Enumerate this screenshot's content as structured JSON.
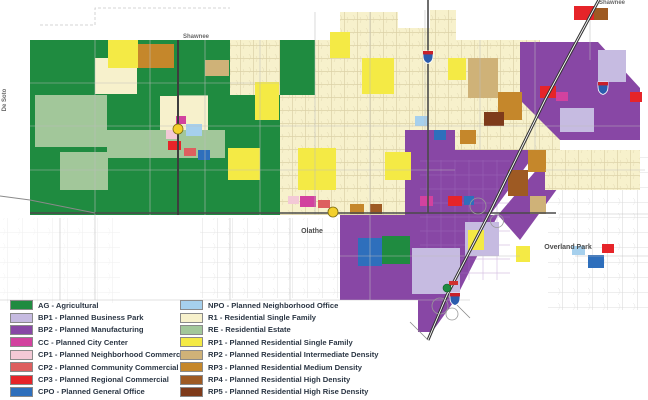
{
  "title": "Future land use zoning map",
  "zone_colors": {
    "AG": "#1f8b40",
    "BP1": "#c6bbe1",
    "BP2": "#8847a5",
    "CC": "#d2429f",
    "CP1": "#f3c9d6",
    "CP2": "#dd5f5f",
    "CP3": "#e62429",
    "CPO": "#2e6fbc",
    "NPO": "#a6d0ed",
    "R1": "#f7f1cc",
    "RE": "#a2c79a",
    "RP1": "#f4ea45",
    "RP2": "#cfb278",
    "RP3": "#c5872b",
    "RP4": "#9e5a23",
    "RP5": "#7e3a1a"
  },
  "map": {
    "labels": {
      "shawnee_inner": "Shawnee",
      "shawnee_corner": "Shawnee",
      "desoto": "De Soto",
      "olathe": "Olathe",
      "overland_park": "Overland Park"
    },
    "markers": {
      "state_route_color": "#f3d02c",
      "interstate_blue": "#2b5cad",
      "interstate_red": "#c8202a"
    }
  },
  "legend": {
    "left": [
      {
        "code": "AG",
        "label": "AG - Agricultural"
      },
      {
        "code": "BP1",
        "label": "BP1 - Planned Business Park"
      },
      {
        "code": "BP2",
        "label": "BP2 - Planned Manufacturing"
      },
      {
        "code": "CC",
        "label": "CC - Planned City Center"
      },
      {
        "code": "CP1",
        "label": "CP1 - Planned Neighborhood Commercial"
      },
      {
        "code": "CP2",
        "label": "CP2 - Planned Community Commercial"
      },
      {
        "code": "CP3",
        "label": "CP3 - Planned Regional Commercial"
      },
      {
        "code": "CPO",
        "label": "CPO - Planned General Office"
      }
    ],
    "right": [
      {
        "code": "NPO",
        "label": "NPO - Planned Neighborhood Office"
      },
      {
        "code": "R1",
        "label": "R1 - Residential Single Family"
      },
      {
        "code": "RE",
        "label": "RE - Residential Estate"
      },
      {
        "code": "RP1",
        "label": "RP1 - Planned Residential Single Family"
      },
      {
        "code": "RP2",
        "label": "RP2 - Planned Residential Intermediate Density"
      },
      {
        "code": "RP3",
        "label": "RP3 - Planned Residential Medium Density"
      },
      {
        "code": "RP4",
        "label": "RP4 - Planned Residential High Density"
      },
      {
        "code": "RP5",
        "label": "RP5 - Planned Residential High Rise Density"
      }
    ]
  }
}
